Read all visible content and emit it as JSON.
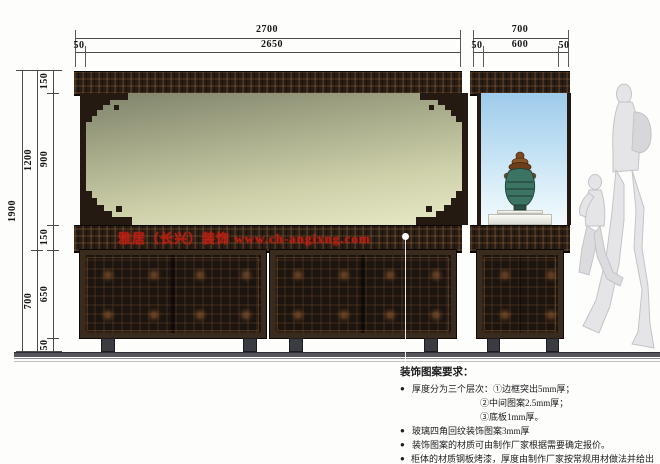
{
  "dimensions": {
    "top_large": {
      "total": "2700",
      "offset_left": "50",
      "inner": "2650"
    },
    "top_small": {
      "total": "700",
      "offset_left": "50",
      "inner": "600",
      "offset_right": "50"
    },
    "left": {
      "total": "1900",
      "upper": "1200",
      "lower": "700",
      "segments": [
        "150",
        "900",
        "150",
        "650",
        "50"
      ]
    }
  },
  "watermark": {
    "text": "雅居（长兴）装饰 www.ch-angixng.com",
    "color": "#c32013"
  },
  "notes": {
    "title": "装饰图案要求：",
    "bullet": "●",
    "items": [
      {
        "text": "厚度分为三个层次：①边框突出5mm厚；"
      },
      {
        "text": "②中间图案2.5mm厚；"
      },
      {
        "text": "③底板1mm厚。"
      },
      {
        "text": "玻璃四角回纹装饰图案3mm厚"
      },
      {
        "text": "装饰图案的材质可由制作厂家根据需要确定报价。"
      },
      {
        "text": "柜体的材质钢板烤漆，厚度由制作厂家按常规用材做法并给出报价。"
      }
    ]
  },
  "colors": {
    "carving_dark": "#281d15",
    "glass_green_top": "#7f836a",
    "glass_green_bottom": "#e8e9c6",
    "glass_blue_top": "#9ecbeb",
    "glass_blue_bottom": "#f4fbfe",
    "watermark_red": "#c32013",
    "dimension_line": "#4a4a4a"
  }
}
